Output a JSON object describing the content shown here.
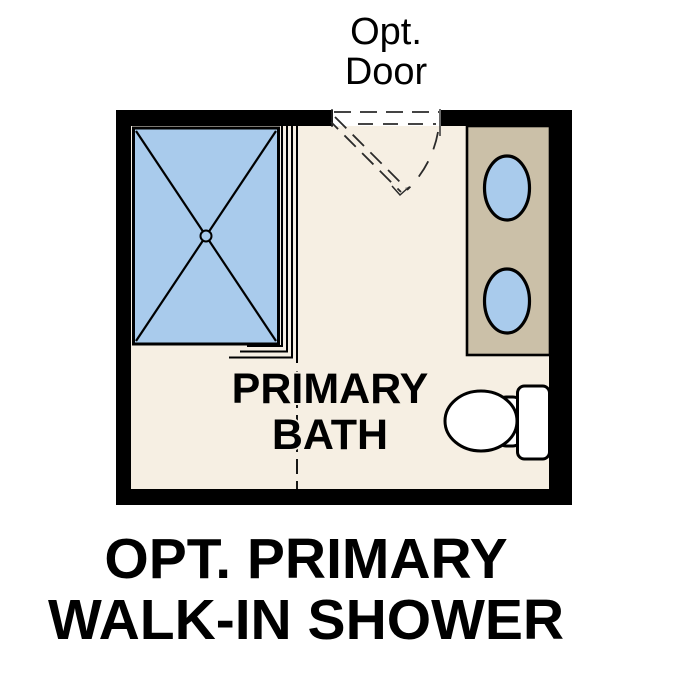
{
  "caption": {
    "line1": "OPT. PRIMARY",
    "line2": "WALK-IN SHOWER"
  },
  "door": {
    "label_line1": "Opt.",
    "label_line2": "Door"
  },
  "room": {
    "label_line1": "PRIMARY",
    "label_line2": "BATH"
  },
  "colors": {
    "wall": "#000000",
    "floor": "#f6efe3",
    "fixture_blue": "#a9cbec",
    "vanity_tan": "#cbc0a8",
    "porcelain": "#ffffff",
    "line": "#000000"
  },
  "fixtures": {
    "shower": "walk-in-shower",
    "vanity": "double-sink-vanity",
    "toilet": "toilet",
    "door": "optional-swing-door"
  }
}
